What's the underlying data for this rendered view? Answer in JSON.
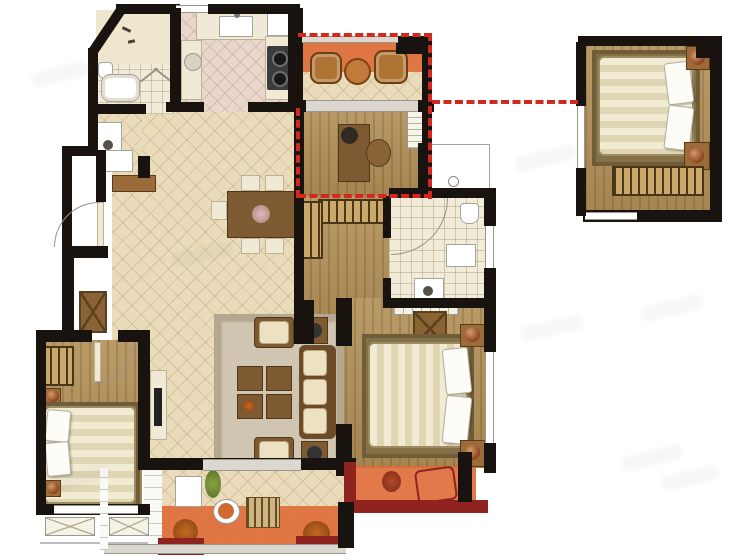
{
  "document": {
    "kind": "residential-floor-plan-rendering",
    "visible_text": "none",
    "canvas_px": {
      "width": 750,
      "height": 560
    }
  },
  "palette": {
    "wall": "#191310",
    "tile_floor": "#eadcba",
    "kitchen_tile": "#e9d7cc",
    "bath_tile": "#f1ebd8",
    "wood_floor": "#b29057",
    "balcony_highlight": "#de6a36",
    "parapet_maroon": "#8e2320",
    "annotation_dashed_red": "#d2281e",
    "window_frame_gray": "#979790",
    "rug": "#cfc5b1",
    "furniture_wood": "#7d5a31",
    "bedding": "#f2ebd3",
    "copper_lamp": "#b06a3c"
  },
  "main_unit": {
    "rooms": [
      {
        "id": "bathroom-1",
        "floor": "bath-tile",
        "items": [
          "toilet",
          "bathtub",
          "shower-screen",
          "vanity-sink"
        ]
      },
      {
        "id": "kitchen",
        "floor": "kitchen-tile",
        "items": [
          "counter-sink",
          "two-burner-cooktop",
          "u-shaped-counter",
          "appliance"
        ]
      },
      {
        "id": "entry-hall",
        "floor": "white-tile",
        "items": [
          "entry-door-swing",
          "shoe-cabinet",
          "console-table",
          "storage-cabinet"
        ]
      },
      {
        "id": "dining-area",
        "floor": "diagonal-tile",
        "items": [
          "dining-table",
          "five-chairs",
          "flower-centerpiece"
        ]
      },
      {
        "id": "north-balcony",
        "floor": "diagonal-tile",
        "highlighted": true,
        "items": [
          "wicker-chair",
          "round-tea-table",
          "wicker-chair"
        ]
      },
      {
        "id": "study",
        "floor": "wood",
        "items": [
          "desk",
          "desk-lamp",
          "desk-chair",
          "wall-shelf"
        ]
      },
      {
        "id": "walk-in-closet",
        "floor": "wood",
        "items": [
          "l-shaped-hanging-wardrobe"
        ]
      },
      {
        "id": "bathroom-2",
        "floor": "bath-tile",
        "items": [
          "curved-shower-enclosure",
          "toilet",
          "bath-mat",
          "vanity-sink",
          "window"
        ]
      },
      {
        "id": "living-room",
        "floor": "diagonal-tile",
        "items": [
          "area-rug",
          "three-seat-sofa",
          "armchair",
          "armchair",
          "four-piece-coffee-table",
          "side-table",
          "side-table",
          "tv-cabinet"
        ]
      },
      {
        "id": "master-bedroom",
        "floor": "wood",
        "items": [
          "double-bed",
          "nightstand-lamp",
          "nightstand-lamp",
          "dresser",
          "built-in-wardrobe",
          "window"
        ]
      },
      {
        "id": "master-balcony",
        "floor": "balcony",
        "highlighted": true,
        "items": [
          "lounge-chair",
          "plant"
        ]
      },
      {
        "id": "bedroom-2",
        "floor": "wood",
        "items": [
          "double-bed",
          "nightstand-lamp",
          "nightstand-lamp",
          "hanging-wardrobe",
          "bay-window-flower-boxes"
        ]
      },
      {
        "id": "south-balcony",
        "floor": "diagonal-tile",
        "highlighted": true,
        "items": [
          "laundry-cabinet",
          "round-table",
          "slatted-bench",
          "plant",
          "plant"
        ]
      },
      {
        "id": "equipment-platform",
        "floor": "white",
        "items": []
      }
    ]
  },
  "detached_room": {
    "id": "optional-bedroom",
    "floor": "wood",
    "items": [
      "double-bed",
      "nightstand-lamp",
      "nightstand-lamp",
      "hanging-wardrobe",
      "window"
    ],
    "linked_by": "red-dashed-connector"
  },
  "annotations": {
    "dashed_outline_encloses": [
      "north-balcony",
      "study"
    ],
    "connector": "horizontal dashed line from outline to detached bedroom",
    "dashed_color": "#d2281e",
    "highlight_color": "#de6a36"
  },
  "watermark": {
    "style": "faint gray diagonal smudges",
    "count": 8
  }
}
